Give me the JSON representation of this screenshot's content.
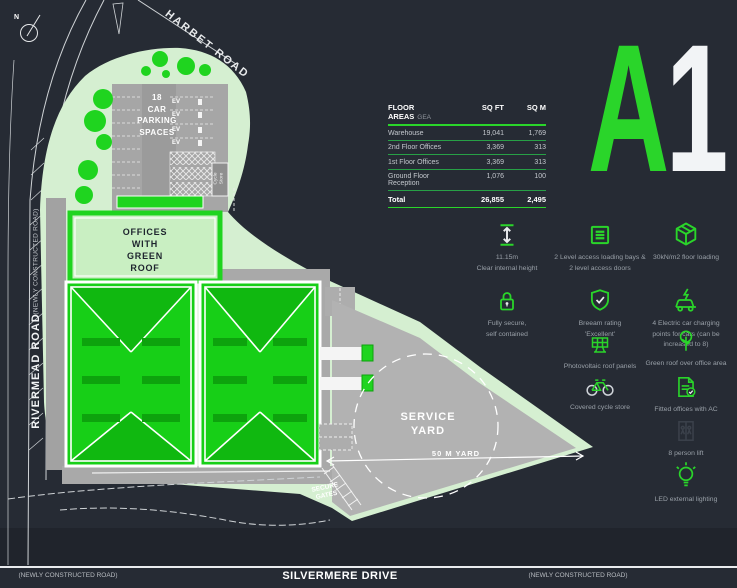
{
  "colors": {
    "background": "#262b34",
    "accent_green": "#2ad52a",
    "roof_green": "#17cf17",
    "pale_green": "#d5efd1",
    "yard_grey": "#b2b2b2",
    "white": "#ffffff"
  },
  "unit_badge": {
    "letter": "A",
    "number": "1"
  },
  "plan": {
    "north": "N",
    "roads": {
      "harbet": "HARBET ROAD",
      "rivermead": "RIVERMEAD ROAD",
      "rivermead_sub": "(NEWLY CONSTRUCTED ROAD)",
      "silvermere": "SILVERMERE DRIVE",
      "bottom_left_sub": "(NEWLY CONSTRUCTED ROAD)",
      "bottom_right_sub": "(NEWLY CONSTRUCTED ROAD)"
    },
    "labels": {
      "car_park": "18\nCAR\nPARKING\nSPACES",
      "ev": "EV",
      "cycle_store": "Cycle\nStore",
      "offices": "OFFICES\nWITH\nGREEN\nROOF",
      "service_yard": "SERVICE\nYARD",
      "yard_dim": "50 M YARD",
      "secure_gates": "SECURE\nGATES"
    }
  },
  "table": {
    "title": "FLOOR AREAS",
    "subtitle": "GEA",
    "col_sqft": "SQ FT",
    "col_sqm": "SQ M",
    "rows": [
      {
        "label": "Warehouse",
        "sqft": "19,041",
        "sqm": "1,769"
      },
      {
        "label": "2nd Floor Offices",
        "sqft": "3,369",
        "sqm": "313"
      },
      {
        "label": "1st Floor Offices",
        "sqft": "3,369",
        "sqm": "313"
      },
      {
        "label": "Ground Floor Reception",
        "sqft": "1,076",
        "sqm": "100"
      }
    ],
    "total": {
      "label": "Total",
      "sqft": "26,855",
      "sqm": "2,495"
    }
  },
  "features": [
    {
      "icon": "height-arrow-icon",
      "label": "11.15m\nClear internal height"
    },
    {
      "icon": "loading-bay-icon",
      "label": "2 Level access loading bays &\n2 level access doors"
    },
    {
      "icon": "cube-icon",
      "label": "30kN/m2 floor loading"
    },
    {
      "icon": "padlock-icon",
      "label": "Fully secure,\nself contained"
    },
    {
      "icon": "shield-check-icon",
      "label": "Breeam rating\n'Excellent'"
    },
    {
      "icon": "ev-charging-icon",
      "label": "4 Electric car charging\npoints for cars (can be\nincreased to 8)"
    },
    {
      "icon": "solar-panel-icon",
      "label": "Photovoltaic roof panels"
    },
    {
      "icon": "green-roof-icon",
      "label": "Green roof over office area"
    },
    {
      "icon": "bicycle-icon",
      "label": "Covered cycle store"
    },
    {
      "icon": "fitted-office-icon",
      "label": "Fitted offices with AC"
    },
    {
      "icon": "lift-icon",
      "label": "8 person lift"
    },
    {
      "icon": "bulb-icon",
      "label": "LED external lighting"
    }
  ]
}
